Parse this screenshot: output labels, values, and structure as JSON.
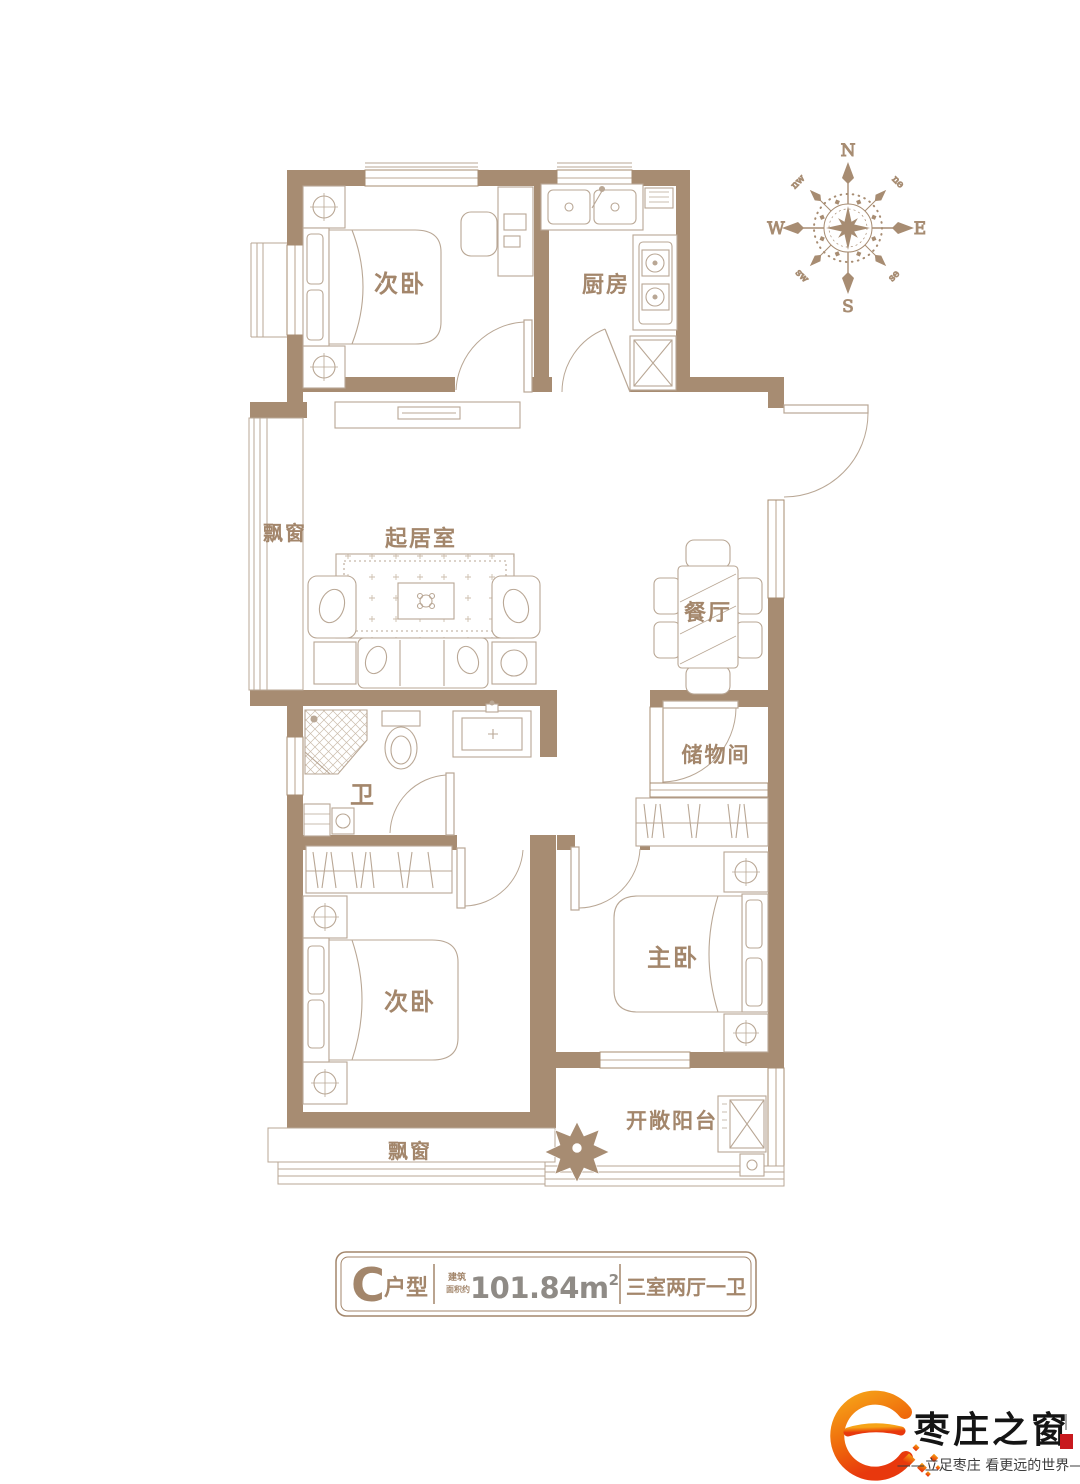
{
  "plan": {
    "rooms": {
      "bedroom_top": "次卧",
      "kitchen": "厨房",
      "bay_window_left": "飘窗",
      "living_room": "起居室",
      "dining_room": "餐厅",
      "bathroom": "卫",
      "storage": "储物间",
      "bedroom_bottom": "次卧",
      "master_bedroom": "主卧",
      "balcony": "开敞阳台",
      "bay_window_bottom": "飘窗"
    },
    "compass": {
      "n": "N",
      "e": "E",
      "s": "S",
      "w": "W",
      "nw": "nw",
      "ne": "ne",
      "sw": "sw",
      "se": "se"
    },
    "colors": {
      "wall": "#a78c72",
      "furniture_line": "#b9a795",
      "label": "#a3866b"
    }
  },
  "info_bar": {
    "type_letter": "C",
    "type_label": "户型",
    "area_note_line1": "建筑",
    "area_note_line2": "面积约",
    "area_value": "101.84",
    "area_unit": "m",
    "area_unit_sup": "2",
    "layout": "三室两厅一卫",
    "number_color": "#8f8b86"
  },
  "footer_logo": {
    "brand": "枣庄之窗",
    "tagline": "——立足枣庄 看更远的世界——",
    "colors": {
      "accent_orange": "#f39800",
      "accent_red": "#e8380d",
      "seal_red": "#c8191e"
    }
  }
}
